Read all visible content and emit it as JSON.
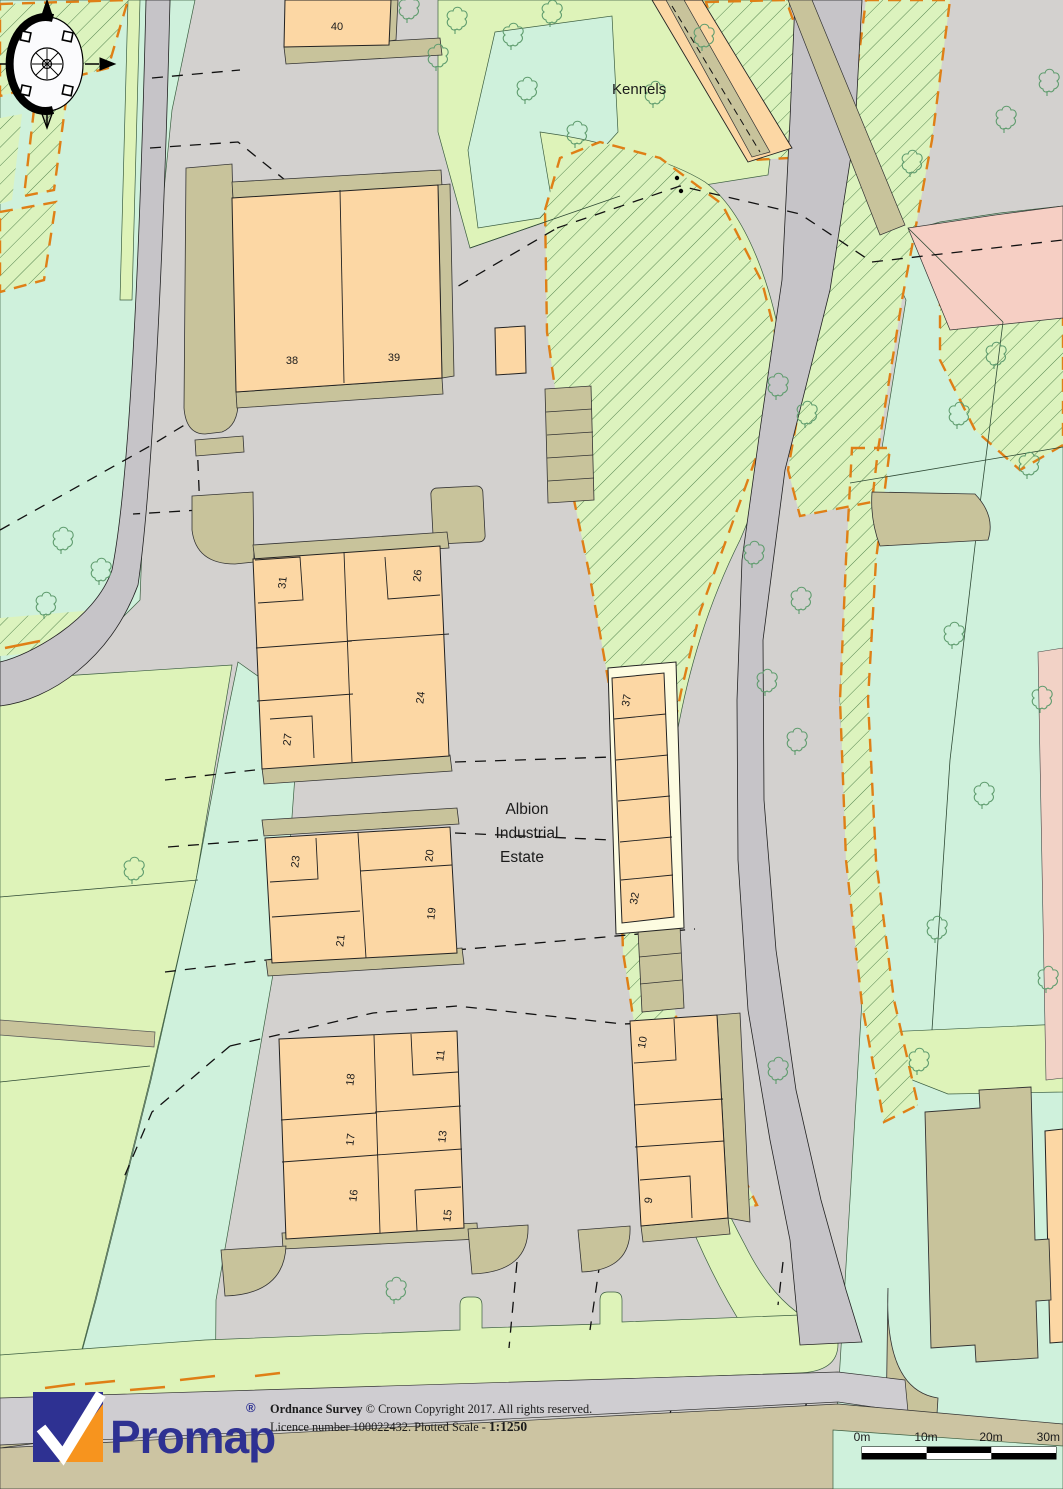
{
  "map": {
    "labels": {
      "kennels": "Kennels",
      "estate_line1": "Albion",
      "estate_line2": "Industrial",
      "estate_line3": "Estate",
      "el": "El"
    },
    "buildings": [
      {
        "label": "40"
      },
      {
        "label": "38"
      },
      {
        "label": "39"
      },
      {
        "label": "31"
      },
      {
        "label": "26"
      },
      {
        "label": "24"
      },
      {
        "label": "27"
      },
      {
        "label": "37"
      },
      {
        "label": "23"
      },
      {
        "label": "20"
      },
      {
        "label": "19"
      },
      {
        "label": "21"
      },
      {
        "label": "32"
      },
      {
        "label": "18"
      },
      {
        "label": "11"
      },
      {
        "label": "17"
      },
      {
        "label": "13"
      },
      {
        "label": "16"
      },
      {
        "label": "15"
      },
      {
        "label": "10"
      },
      {
        "label": "9"
      }
    ]
  },
  "footer": {
    "logo": {
      "text": "Promap",
      "registered": "®"
    },
    "copyright": {
      "line1_bold": "Ordnance Survey",
      "line1_rest": " © Crown Copyright 2017. All rights reserved.",
      "line2_prefix": "Licence number 100022432. Plotted Scale - ",
      "line2_scale": "1:1250"
    }
  },
  "scalebar": {
    "labels": [
      "0m",
      "10m",
      "20m",
      "30m"
    ]
  },
  "colors": {
    "estate_gray": "#D3D1CF",
    "road_gray": "#C6C4C8",
    "field_green": "#DEF3B9",
    "mint_green": "#CFF1DC",
    "hatch_green_bg": "#DCF3BE",
    "hatch_line_green": "#55854F",
    "building_peach": "#FCD7A4",
    "khaki": "#C8C39B",
    "cream_surround": "#FDFCE1",
    "pink_road": "#F6CFC4",
    "orange_marking": "#DF7F16",
    "logo_blue": "#2E3192",
    "logo_orange": "#F7941E"
  }
}
